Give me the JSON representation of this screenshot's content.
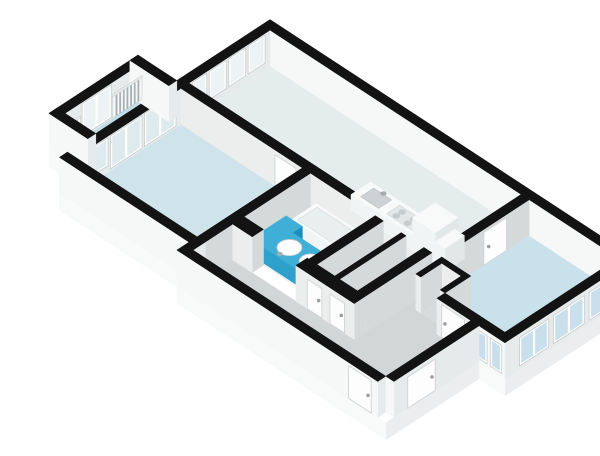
{
  "scene": {
    "kind": "isometric-3d-floorplan-render",
    "canvas": {
      "width": 600,
      "height": 424
    }
  },
  "palette": {
    "background": "#ffffff",
    "wall_top": "#131313",
    "wall_face_u": "#d6d9da",
    "wall_face_v": "#eceeee",
    "ext_face_u": "#e7eaea",
    "ext_face_v": "#f6f7f7",
    "plinth_u": "#ebedee",
    "plinth_v": "#f8f9f9",
    "frame": "#ffffff",
    "frame_edge": "#c7cccd",
    "glass_in": "#edf2f4",
    "glass_mid": "#dfeaef",
    "glass_out": "#c9e0ec",
    "rail_bg": "#f6f8f8",
    "bar": "#a7b1b5",
    "rail_top": "#e9ebec",
    "door": "#fdfdfd",
    "door_edge": "#cfd3d4",
    "metal": "#9aa0a2",
    "floor_living": "#e4ecec",
    "floor_bed1": "#c9e1ea",
    "floor_bed2": "#cfe4ea",
    "floor_balcony": "#c2dce6",
    "floor_bath": "#eef1f1",
    "floor_wc_a": "#e3e6e7",
    "floor_wc_b": "#e8ebeb",
    "floor_hall": "#d3d6d7",
    "floor_notch": "#d8dbdc"
  },
  "fixture_colors": {
    "white": {
      "t": "#f8fafa",
      "u": "#e2e7e8",
      "v": "#f1f4f4"
    },
    "accent": {
      "t": "#3fafd8",
      "u": "#1f8cbc",
      "v": "#2ea0cc"
    }
  },
  "geometry": {
    "projection": {
      "ox": 230,
      "oy": 50,
      "k": 0.81,
      "m": 0.53,
      "h": 0.78
    },
    "wall_height": 46,
    "plinth_depth": 22,
    "plinth_faces": [
      {
        "t": "u",
        "a": [
          440,
          -10
        ],
        "b": [
          440,
          150
        ]
      },
      {
        "t": "v",
        "a": [
          440,
          150
        ],
        "b": [
          408,
          150
        ]
      },
      {
        "t": "u",
        "a": [
          408,
          150
        ],
        "b": [
          408,
          265
        ]
      },
      {
        "t": "v",
        "a": [
          408,
          265
        ],
        "b": [
          150,
          265
        ]
      },
      {
        "t": "v",
        "a": [
          150,
          250
        ],
        "b": [
          -10,
          250
        ]
      },
      {
        "t": "v",
        "a": [
          -10,
          215
        ],
        "b": [
          -58,
          215
        ]
      }
    ],
    "floors": [
      {
        "n": "floor-living-room",
        "f": "floor_living",
        "r": [
          0,
          310,
          0,
          100
        ]
      },
      {
        "n": "floor-bedroom-2",
        "f": "floor_bed2",
        "r": [
          0,
          150,
          110,
          240
        ]
      },
      {
        "n": "floor-balcony",
        "f": "floor_balcony",
        "r": [
          -48,
          -10,
          115,
          205
        ]
      },
      {
        "n": "floor-bathroom",
        "f": "floor_bath",
        "r": [
          160,
          240,
          110,
          192
        ]
      },
      {
        "n": "floor-storage",
        "f": "floor_wc_a",
        "r": [
          250,
          272,
          110,
          192
        ]
      },
      {
        "n": "floor-wc",
        "f": "floor_wc_b",
        "r": [
          278,
          300,
          110,
          192
        ]
      },
      {
        "n": "floor-corridor",
        "f": "floor_hall",
        "r": [
          160,
          356,
          206,
          255
        ]
      },
      {
        "n": "floor-hall-branch",
        "f": "floor_hall",
        "r": [
          310,
          356,
          110,
          206
        ]
      },
      {
        "n": "floor-entry-hall",
        "f": "floor_hall",
        "r": [
          356,
          398,
          110,
          255
        ]
      },
      {
        "n": "floor-bedroom-1",
        "f": "floor_bed1",
        "poly": [
          [
            320,
            0
          ],
          [
            430,
            0
          ],
          [
            430,
            140
          ],
          [
            356,
            140
          ],
          [
            356,
            108
          ],
          [
            320,
            108
          ]
        ]
      },
      {
        "n": "floor-duct-nook",
        "f": "floor_notch",
        "r": [
          326,
          350,
          114,
          140
        ]
      }
    ],
    "walls": [
      {
        "n": "ne-facade",
        "b": [
          -10,
          440,
          -10,
          0
        ],
        "ext": true
      },
      {
        "n": "nw-facade",
        "b": [
          -10,
          0,
          0,
          250
        ],
        "ext": true
      },
      {
        "n": "sw-facade-a",
        "b": [
          -10,
          150,
          240,
          250
        ],
        "ext": true
      },
      {
        "n": "step-wall",
        "b": [
          150,
          160,
          240,
          265
        ],
        "ext": true
      },
      {
        "n": "sw-facade-b",
        "b": [
          160,
          398,
          255,
          265
        ],
        "ext": true
      },
      {
        "n": "hall-ne-ext",
        "b": [
          398,
          408,
          150,
          255
        ],
        "ext": true
      },
      {
        "n": "bed1-sw-int",
        "b": [
          356,
          398,
          140,
          150
        ],
        "ext": false
      },
      {
        "n": "bed1-sw-ext",
        "b": [
          398,
          440,
          140,
          150
        ],
        "ext": true
      },
      {
        "n": "bed1-se-ext",
        "b": [
          430,
          440,
          -10,
          140
        ],
        "ext": true
      },
      {
        "n": "balcony-nw",
        "b": [
          -58,
          -48,
          105,
          215
        ],
        "ext": true
      },
      {
        "n": "balcony-ne",
        "b": [
          -58,
          -10,
          105,
          115
        ],
        "ext": true
      },
      {
        "n": "balcony-sw",
        "b": [
          -58,
          -10,
          205,
          215
        ],
        "ext": true
      },
      {
        "n": "living-divider",
        "b": [
          0,
          320,
          100,
          110
        ],
        "ext": false
      },
      {
        "n": "living-bed1-divider",
        "b": [
          310,
          320,
          0,
          100
        ],
        "ext": false
      },
      {
        "n": "bed2-bath-divider",
        "b": [
          150,
          160,
          110,
          240
        ],
        "ext": false
      },
      {
        "n": "bath-wc-divider",
        "b": [
          240,
          250,
          110,
          192
        ],
        "ext": false,
        "k": 380
      },
      {
        "n": "wc-split-wall",
        "b": [
          272,
          278,
          110,
          192
        ],
        "ext": false
      },
      {
        "n": "wc-branch-divider",
        "b": [
          300,
          310,
          110,
          192
        ],
        "ext": false
      },
      {
        "n": "bath-corridor-wall-a",
        "b": [
          160,
          184,
          192,
          206
        ],
        "ext": false
      },
      {
        "n": "bath-corridor-wall-b",
        "b": [
          238,
          310,
          192,
          206
        ],
        "ext": false
      },
      {
        "n": "duct-nook-wall-a",
        "b": [
          320,
          356,
          108,
          114
        ],
        "ext": false
      },
      {
        "n": "duct-nook-wall-b",
        "b": [
          320,
          326,
          114,
          140
        ],
        "ext": false
      },
      {
        "n": "duct-nook-wall-c",
        "b": [
          350,
          356,
          114,
          140
        ],
        "ext": false
      }
    ],
    "windows": [
      {
        "n": "living-window-1",
        "wall": "nw-facade",
        "face": "u",
        "s": [
          6,
          27
        ],
        "z": [
          8,
          44
        ],
        "g": "glass_in"
      },
      {
        "n": "living-window-2",
        "wall": "nw-facade",
        "face": "u",
        "s": [
          30,
          51
        ],
        "z": [
          8,
          44
        ],
        "g": "glass_in"
      },
      {
        "n": "living-window-3",
        "wall": "nw-facade",
        "face": "u",
        "s": [
          54,
          75
        ],
        "z": [
          8,
          44
        ],
        "g": "glass_in"
      },
      {
        "n": "living-window-4",
        "wall": "nw-facade",
        "face": "u",
        "s": [
          78,
          96
        ],
        "z": [
          8,
          44
        ],
        "g": "glass_in"
      },
      {
        "n": "bed2-slider-1",
        "wall": "nw-facade",
        "face": "u",
        "s": [
          116,
          155
        ],
        "z": [
          2,
          44
        ],
        "g": "glass_mid"
      },
      {
        "n": "bed2-slider-2",
        "wall": "nw-facade",
        "face": "u",
        "s": [
          158,
          197
        ],
        "z": [
          2,
          44
        ],
        "g": "glass_mid"
      },
      {
        "n": "bed2-window",
        "wall": "nw-facade",
        "face": "u",
        "s": [
          200,
          237
        ],
        "z": [
          8,
          44
        ],
        "g": "glass_mid"
      },
      {
        "n": "balcony-glass-door",
        "wall": "balcony-nw",
        "face": "u",
        "s": [
          148,
          184
        ],
        "z": [
          2,
          44
        ],
        "g": "glass_in"
      },
      {
        "n": "bed1-window-1",
        "wall": "bed1-se-ext",
        "face": "u",
        "s": [
          8,
          46
        ],
        "z": [
          4,
          40
        ],
        "g": "glass_out"
      },
      {
        "n": "bed1-window-2",
        "wall": "bed1-se-ext",
        "face": "u",
        "s": [
          52,
          90
        ],
        "z": [
          4,
          40
        ],
        "g": "glass_out"
      },
      {
        "n": "bed1-window-3",
        "wall": "bed1-se-ext",
        "face": "u",
        "s": [
          96,
          132
        ],
        "z": [
          4,
          40
        ],
        "g": "glass_out"
      },
      {
        "n": "bed1-window-4",
        "wall": "bed1-sw-ext",
        "face": "v",
        "s": [
          402,
          418
        ],
        "z": [
          4,
          40
        ],
        "g": "glass_out"
      },
      {
        "n": "bed1-window-5",
        "wall": "bed1-sw-ext",
        "face": "v",
        "s": [
          422,
          436
        ],
        "z": [
          4,
          40
        ],
        "g": "glass_out"
      }
    ],
    "railings": [
      {
        "n": "balcony-railing-1",
        "wall": "balcony-nw",
        "face": "u",
        "s": [
          110,
          146
        ],
        "z": [
          0,
          30
        ],
        "bars": 8
      },
      {
        "n": "balcony-railing-2",
        "wall": "balcony-nw",
        "face": "u",
        "s": [
          186,
          211
        ],
        "z": [
          0,
          30
        ],
        "bars": 6
      }
    ],
    "doors": [
      {
        "n": "entry-door",
        "wall": "sw-facade-b",
        "face": "v",
        "s": [
          362,
          390
        ],
        "z": [
          0,
          42
        ],
        "h": 386
      },
      {
        "n": "ext-storage-door",
        "wall": "hall-ne-ext",
        "face": "u",
        "s": [
          204,
          238
        ],
        "z": [
          0,
          40
        ],
        "h": 208
      },
      {
        "n": "bed1-door",
        "wall": "bed1-sw-int",
        "face": "v",
        "s": [
          362,
          390
        ],
        "z": [
          0,
          42
        ],
        "h": 366
      },
      {
        "n": "wc-door-1",
        "wall": "bath-corridor-wall-b",
        "face": "v",
        "s": [
          252,
          270
        ],
        "z": [
          0,
          38
        ],
        "h": 266
      },
      {
        "n": "wc-door-2",
        "wall": "bath-corridor-wall-b",
        "face": "v",
        "s": [
          280,
          298
        ],
        "z": [
          0,
          38
        ],
        "h": 294
      },
      {
        "n": "living-door",
        "wall": "living-bed1-divider",
        "face": "u",
        "s": [
          28,
          56
        ],
        "z": [
          0,
          42
        ],
        "h": 50
      },
      {
        "n": "bed2-door",
        "wall": "living-divider",
        "face": "v",
        "s": [
          116,
          142
        ],
        "z": [
          0,
          40
        ],
        "h": 138
      }
    ],
    "fixtures": [
      {
        "n": "bathtub",
        "t": "box",
        "b": [
          170,
          236,
          113,
          143,
          0,
          16
        ],
        "c": "white"
      },
      {
        "n": "bathtub-basin",
        "t": "prect",
        "r": [
          174,
          232,
          116,
          140
        ],
        "z": 16,
        "f": "#e9efef",
        "s": "#d8e0e0"
      },
      {
        "n": "vanity-arm-long",
        "t": "box",
        "b": [
          166,
          186,
          146,
          190,
          0,
          20
        ],
        "c": "accent"
      },
      {
        "n": "vanity-arm-short",
        "t": "box",
        "b": [
          186,
          234,
          158,
          190,
          0,
          20
        ],
        "c": "accent"
      },
      {
        "n": "sink-left",
        "t": "circle",
        "c0": [
          198,
          174
        ],
        "rad": 11,
        "z": 20,
        "f": "#fcfeff",
        "s": "#c2cbcd"
      },
      {
        "n": "sink-right",
        "t": "circle",
        "c0": [
          224,
          174
        ],
        "rad": 10,
        "z": 20,
        "f": "#fcfeff",
        "s": "#c2cbcd"
      },
      {
        "n": "faucet-left",
        "t": "circle",
        "c0": [
          198,
          186
        ],
        "rad": 2.2,
        "z": 20,
        "f": "#a6adaf"
      },
      {
        "n": "faucet-right",
        "t": "circle",
        "c0": [
          224,
          185
        ],
        "rad": 2.2,
        "z": 20,
        "f": "#a6adaf"
      },
      {
        "n": "toilet-tank",
        "t": "box",
        "b": [
          282,
          296,
          114,
          119,
          0,
          18
        ],
        "c": "white"
      },
      {
        "n": "toilet-base",
        "t": "box",
        "b": [
          283,
          295,
          119,
          133,
          0,
          10
        ],
        "c": "white"
      },
      {
        "n": "toilet-bowl",
        "t": "circle",
        "c0": [
          289,
          127
        ],
        "rad": 7.5,
        "z": 10,
        "f": "#ffffff",
        "s": "#ccd4d5"
      },
      {
        "n": "kitchen-counter",
        "t": "box",
        "b": [
          186,
          266,
          62,
          86,
          0,
          20
        ],
        "c": "white"
      },
      {
        "n": "kitchen-sink",
        "t": "prect",
        "r": [
          194,
          216,
          66,
          82
        ],
        "z": 20,
        "f": "#cdd3d5",
        "s": "#bfc6c8"
      },
      {
        "n": "kitchen-faucet",
        "t": "circle",
        "c0": [
          205,
          65
        ],
        "rad": 2.4,
        "z": 20,
        "f": "#a6adaf"
      },
      {
        "n": "cooktop",
        "t": "prect",
        "r": [
          226,
          258,
          66,
          82
        ],
        "z": 20,
        "f": "#e3e7e8",
        "s": "#d5dadb"
      },
      {
        "n": "burner-1",
        "t": "circle",
        "c0": [
          234,
          71
        ],
        "rad": 3,
        "z": 20,
        "f": "#c6cccd"
      },
      {
        "n": "burner-2",
        "t": "circle",
        "c0": [
          248,
          71
        ],
        "rad": 3,
        "z": 20,
        "f": "#c6cccd"
      },
      {
        "n": "burner-3",
        "t": "circle",
        "c0": [
          234,
          78
        ],
        "rad": 3,
        "z": 20,
        "f": "#c6cccd"
      },
      {
        "n": "burner-4",
        "t": "circle",
        "c0": [
          248,
          78
        ],
        "rad": 3,
        "z": 20,
        "f": "#c6cccd"
      },
      {
        "n": "fridge",
        "t": "box",
        "b": [
          262,
          290,
          58,
          86,
          0,
          42
        ],
        "c": "white"
      },
      {
        "n": "kitchen-cabinet",
        "t": "box",
        "b": [
          290,
          302,
          62,
          86,
          0,
          30
        ],
        "c": "white"
      }
    ]
  }
}
